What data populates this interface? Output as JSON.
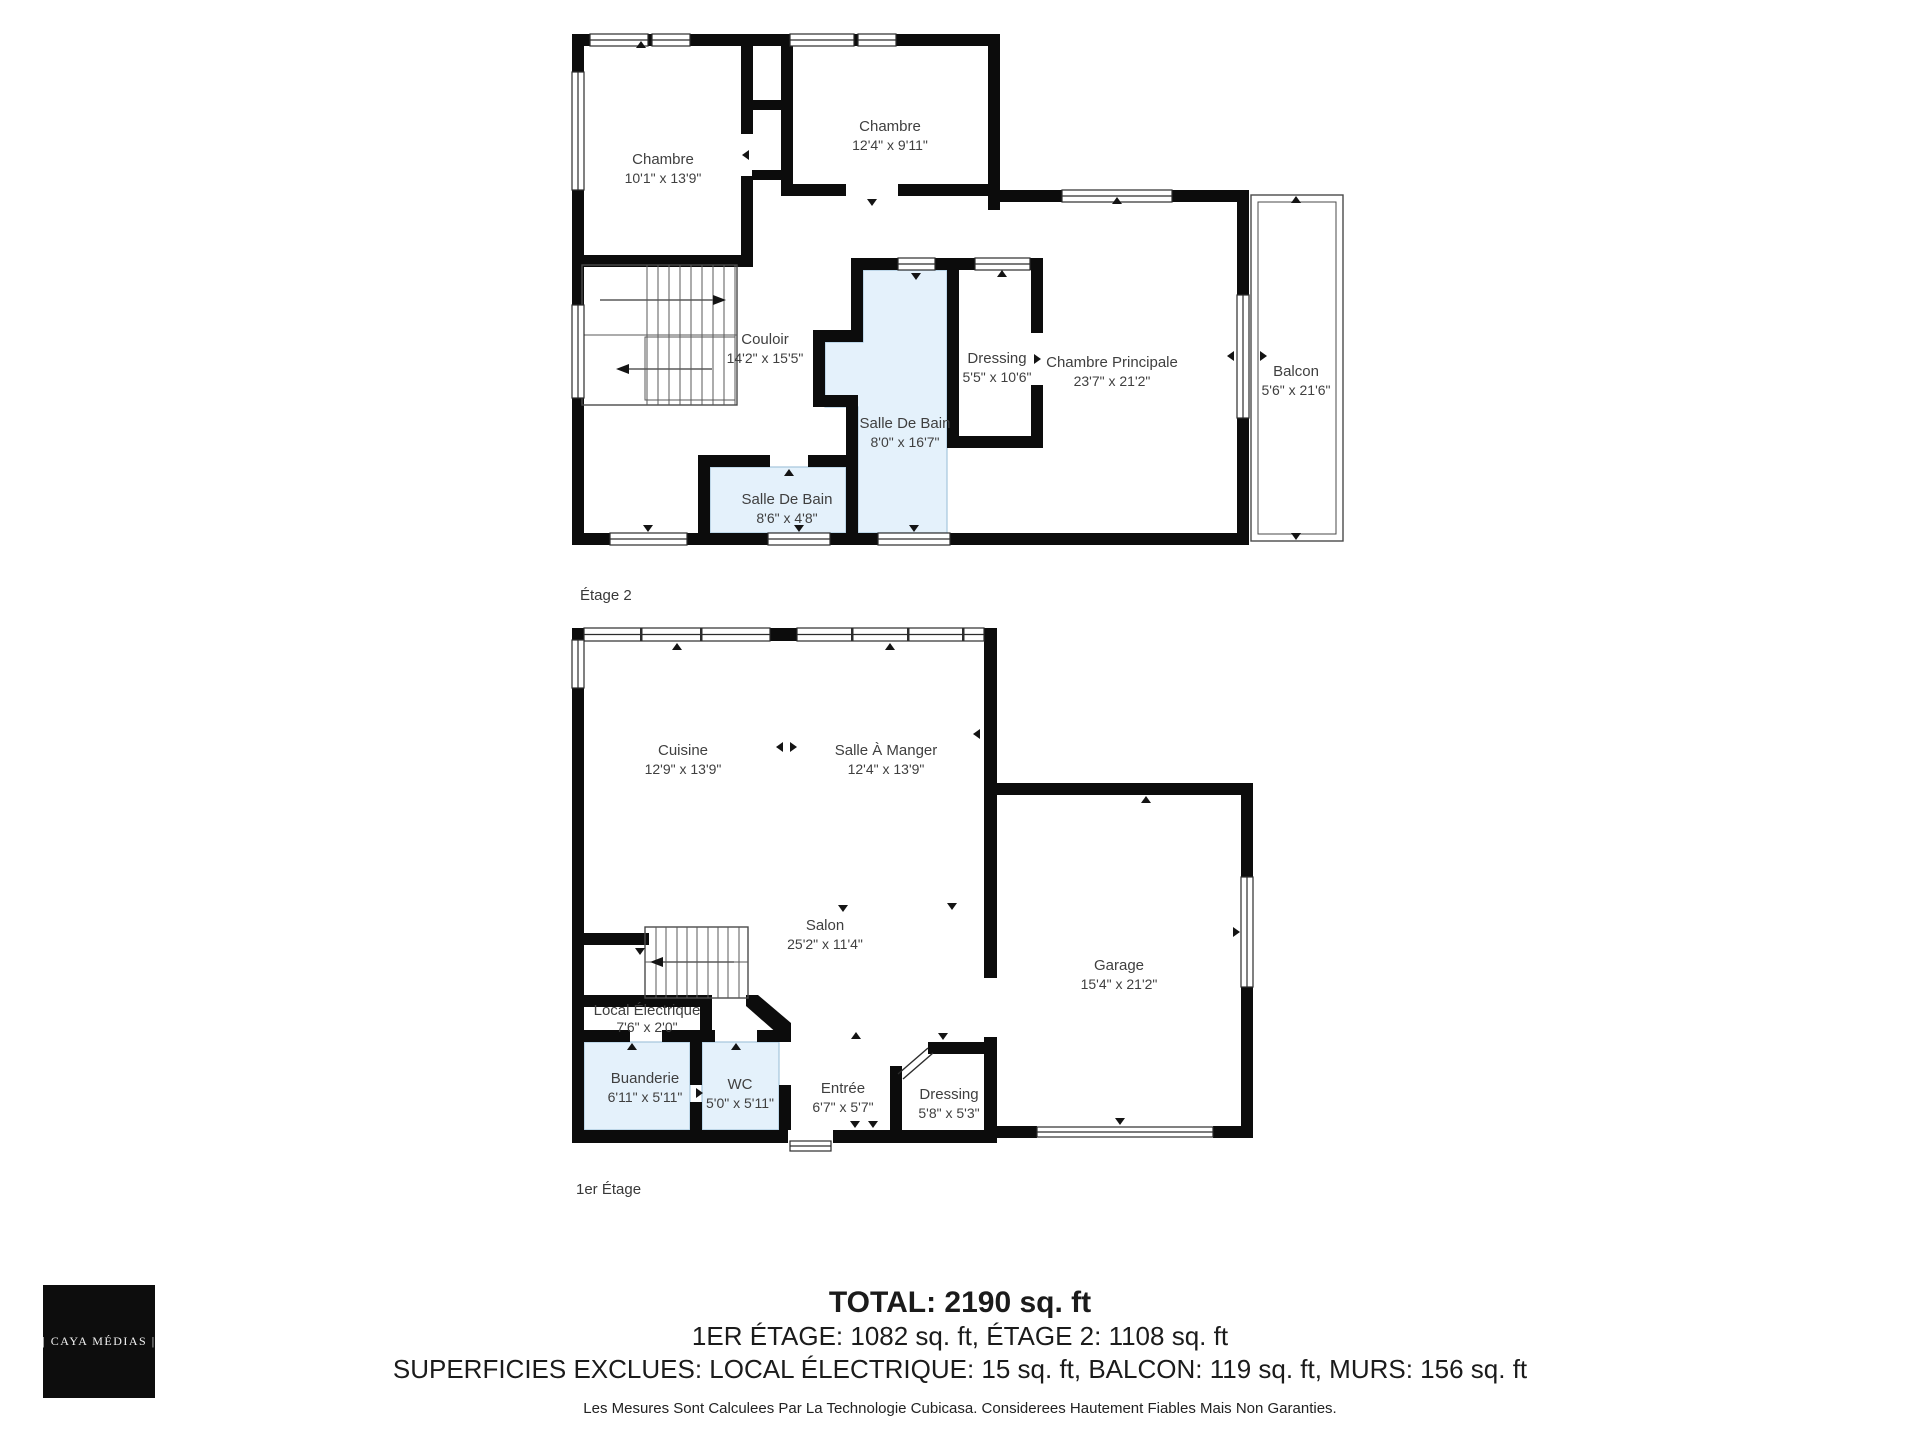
{
  "colors": {
    "wall": "#0c0c0c",
    "room_highlight": "#e4f1fb",
    "highlight_border": "#a5c6dd",
    "plan_text": "#3f3f3f",
    "summary_text": "#1b1b1b",
    "logo_bg": "#0d0d0d",
    "logo_text": "#f2f2f2"
  },
  "floor2": {
    "caption": "Étage 2",
    "rooms": {
      "chambre_1": {
        "name": "Chambre",
        "dims": "10'1\" x 13'9\""
      },
      "chambre_2": {
        "name": "Chambre",
        "dims": "12'4\" x 9'11\""
      },
      "couloir": {
        "name": "Couloir",
        "dims": "14'2\" x 15'5\""
      },
      "salle_de_bain": {
        "name": "Salle De Bain",
        "dims": "8'0\" x 16'7\""
      },
      "dressing": {
        "name": "Dressing",
        "dims": "5'5\" x 10'6\""
      },
      "chambre_principale": {
        "name": "Chambre Principale",
        "dims": "23'7\" x 21'2\""
      },
      "balcon": {
        "name": "Balcon",
        "dims": "5'6\" x 21'6\""
      },
      "salle_de_bain_2": {
        "name": "Salle De Bain",
        "dims": "8'6\" x 4'8\""
      }
    }
  },
  "floor1": {
    "caption": "1er Étage",
    "rooms": {
      "cuisine": {
        "name": "Cuisine",
        "dims": "12'9\" x 13'9\""
      },
      "salle_a_manger": {
        "name": "Salle À Manger",
        "dims": "12'4\" x 13'9\""
      },
      "salon": {
        "name": "Salon",
        "dims": "25'2\" x 11'4\""
      },
      "garage": {
        "name": "Garage",
        "dims": "15'4\" x 21'2\""
      },
      "local_electrique": {
        "name": "Local Électrique",
        "dims": "7'6\" x 2'0\""
      },
      "buanderie": {
        "name": "Buanderie",
        "dims": "6'11\" x 5'11\""
      },
      "wc": {
        "name": "WC",
        "dims": "5'0\" x 5'11\""
      },
      "entree": {
        "name": "Entrée",
        "dims": "6'7\" x 5'7\""
      },
      "dressing": {
        "name": "Dressing",
        "dims": "5'8\" x 5'3\""
      }
    }
  },
  "summary": {
    "total": "TOTAL: 2190 sq. ft",
    "floors_line": "1ER ÉTAGE: 1082 sq. ft, ÉTAGE 2: 1108 sq. ft",
    "exclusions_line": "SUPERFICIES EXCLUES: LOCAL ÉLECTRIQUE: 15 sq. ft, BALCON: 119 sq. ft, MURS: 156 sq. ft",
    "disclaimer": "Les Mesures Sont Calculees Par La Technologie Cubicasa. Considerees Hautement Fiables Mais Non Garanties."
  },
  "logo": {
    "text": "| CAYA MÉDIAS |"
  }
}
